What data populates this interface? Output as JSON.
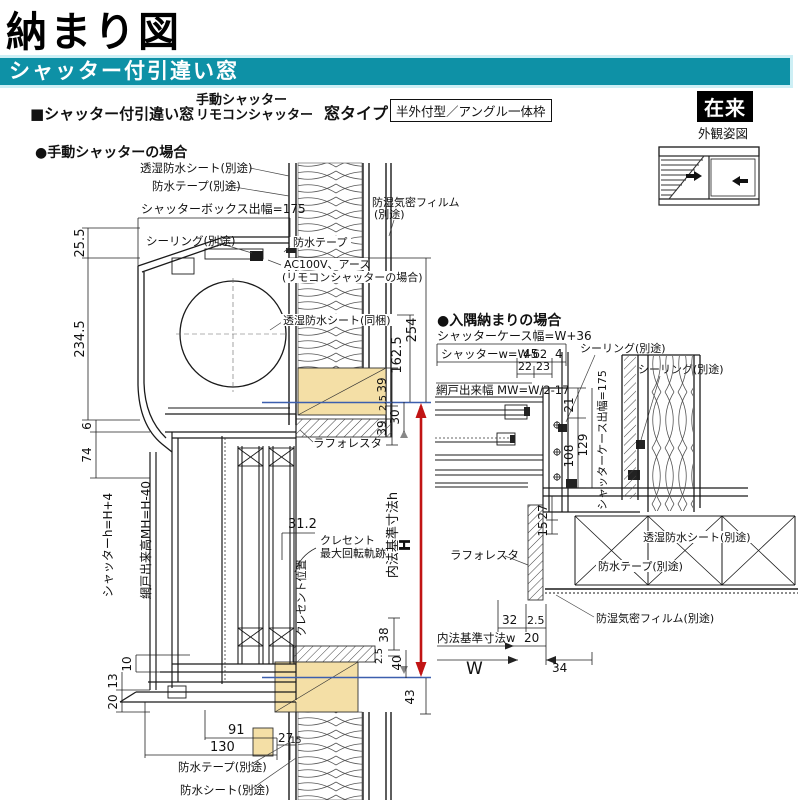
{
  "header": {
    "title": "納まり図",
    "banner": "シャッター付引違い窓",
    "product": "■シャッター付引違い窓",
    "type1": "手動シャッター",
    "type2": "リモコンシャッター",
    "window_type_label": "窓タイプ",
    "window_type_value": "半外付型／アングル一体枠",
    "badge": "在来",
    "view_label": "外観姿図"
  },
  "manual": {
    "heading": "●手動シャッターの場合",
    "labels": {
      "sheet_top": "透湿防水シート(別途)",
      "tape_top": "防水テープ(別途)",
      "box_width": "シャッターボックス出幅=175",
      "sealing": "シーリング(別途)",
      "tape_wall": "防水テープ",
      "ac": "AC100V、アース",
      "ac2": "(リモコンシャッターの場合)",
      "film": "防湿気密フィルム",
      "film2": "(別途)",
      "sheet_mid": "透湿防水シート(同梱)",
      "laforesta": "ラフォレスタ",
      "crescent1": "クレセント",
      "crescent2": "最大回転軌跡",
      "crescent_pos": "クレセント位置",
      "shutter_h": "シャッターh=H+4",
      "screen_h": "網戸出来高MH=H-40",
      "inner_h": "内法基準寸法h",
      "H": "H",
      "tape_bottom": "防水テープ(別途)",
      "sheet_bottom": "防水シート(別途)"
    },
    "dims": {
      "d25_5": "25.5",
      "d234_5": "234.5",
      "d6": "6",
      "d74": "74",
      "d254": "254",
      "d162_5": "162.5",
      "d39a": "39",
      "d2_5a": "2.5",
      "d30": "30",
      "d39b": "39",
      "d31_2": "31.2",
      "d38": "38",
      "d2_5b": "2.5",
      "d40": "40",
      "d43": "43",
      "d10": "10",
      "d13": "13",
      "d20": "20",
      "d91": "91",
      "d130": "130",
      "d27": "27",
      "d15": "15"
    }
  },
  "corner": {
    "heading": "●入隅納まりの場合",
    "labels": {
      "case_w": "シャッターケース幅=W+36",
      "shutter_w": "シャッターw=W-62",
      "sealing1": "シーリング(別途)",
      "sealing2": "シーリング(別途)",
      "screen_w": "網戸出来幅 MW=W/2-17",
      "case_d": "シャッターケース出幅=175",
      "laforesta": "ラフォレスタ",
      "sheet": "透湿防水シート(別途)",
      "tape": "防水テープ(別途)",
      "film": "防湿気密フィルム(別途)",
      "inner_w": "内法基準寸法w",
      "W": "W"
    },
    "dims": {
      "d45": "45",
      "d4": "4",
      "d22": "22",
      "d23": "23",
      "d21": "21",
      "d129": "129",
      "d108": "108",
      "d27": "27",
      "d15": "15",
      "d32": "32",
      "d2_5": "2.5",
      "d20": "20",
      "d34": "34"
    }
  },
  "colors": {
    "banner": "#0e91a6",
    "banner_edge": "#cdeff5",
    "wood": "#f4dfa6",
    "dim_red": "#c11414",
    "datum_blue": "#3c5fae"
  }
}
